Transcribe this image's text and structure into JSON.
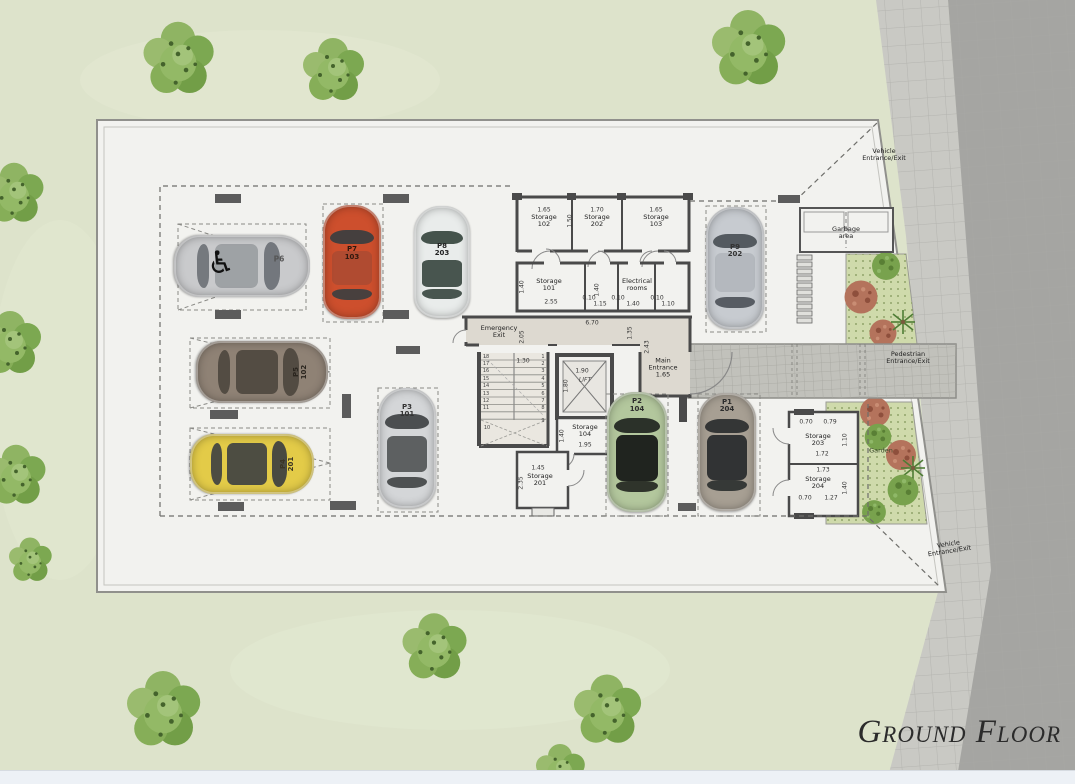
{
  "title": "Ground Floor",
  "entrances": {
    "vehicle_top": {
      "l1": "Vehicle",
      "l2": "Entrance/Exit"
    },
    "vehicle_bottom": {
      "l1": "Vehicle",
      "l2": "Entrance/Exit"
    },
    "pedestrian": {
      "l1": "Pedestrian",
      "l2": "Entrance/Exit"
    },
    "main": {
      "l1": "Main",
      "l2": "Entrance",
      "dim": "1.65"
    },
    "emergency": {
      "l1": "Emergency",
      "l2": "Exit"
    }
  },
  "areas": {
    "garbage": {
      "l1": "Garbage",
      "l2": "area"
    },
    "garden": "Garden",
    "lift": "LIFT",
    "electrical": {
      "l1": "Electrical",
      "l2": "rooms"
    }
  },
  "rooms": {
    "s102": {
      "name": "Storage",
      "number": "102"
    },
    "s202": {
      "name": "Storage",
      "number": "202"
    },
    "s103": {
      "name": "Storage",
      "number": "103"
    },
    "s101": {
      "name": "Storage",
      "number": "101"
    },
    "s104": {
      "name": "Storage",
      "number": "104"
    },
    "s201": {
      "name": "Storage",
      "number": "201"
    },
    "s203": {
      "name": "Storage",
      "number": "203"
    },
    "s204": {
      "name": "Storage",
      "number": "204"
    }
  },
  "parking": {
    "handicap_symbol": "♿",
    "p6_label": "P6",
    "spots": [
      {
        "label": "P7",
        "unit": "103",
        "cx": 352,
        "cy": 262,
        "w": 58,
        "h": 114,
        "rot": 0,
        "body": "#cd4f2d",
        "glass": "#3a3e40",
        "ro": 0.2,
        "rft": 40,
        "rfh": 30,
        "lt": "36%",
        "lr": 0,
        "lc": "#30180e"
      },
      {
        "label": "P8",
        "unit": "203",
        "cx": 442,
        "cy": 262,
        "w": 56,
        "h": 112,
        "rot": 0,
        "body": "#e9eceb",
        "glass": "#36453e",
        "ro": 0.9,
        "rft": 48,
        "rfh": 24,
        "lt": "33%",
        "lr": 0,
        "lc": "#222222"
      },
      {
        "label": "P9",
        "unit": "202",
        "cx": 735,
        "cy": 268,
        "w": 58,
        "h": 122,
        "rot": 0,
        "body": "#c7cbd0",
        "glass": "#4a5056",
        "ro": 0.15,
        "rft": 38,
        "rfh": 32,
        "lt": "30%",
        "lr": 0,
        "lc": "#333333"
      },
      {
        "label": "P5",
        "unit": "102",
        "cx": 262,
        "cy": 372,
        "w": 62,
        "h": 132,
        "rot": 90,
        "body": "#8f8275",
        "glass": "#4d463e",
        "ro": 0.9,
        "rft": 38,
        "rfh": 32,
        "lt": "15%",
        "lr": 180,
        "lc": "#2b261f"
      },
      {
        "label": "P4",
        "unit": "201",
        "cx": 252,
        "cy": 464,
        "w": 60,
        "h": 124,
        "rot": 90,
        "body": "#e3cb48",
        "glass": "#3c3f41",
        "ro": 0.9,
        "rft": 38,
        "rfh": 32,
        "lt": "15%",
        "lr": 180,
        "lc": "#3a3424"
      },
      {
        "label": "P3",
        "unit": "101",
        "cx": 407,
        "cy": 448,
        "w": 58,
        "h": 120,
        "rot": 0,
        "body": "#d4d6d8",
        "glass": "#3f4244",
        "ro": 0.8,
        "rft": 40,
        "rfh": 30,
        "lt": "13%",
        "lr": 0,
        "lc": "#333333"
      },
      {
        "label": "P2",
        "unit": "104",
        "cx": 637,
        "cy": 452,
        "w": 60,
        "h": 120,
        "rot": 0,
        "body": "#b3c79d",
        "glass": "#20241f",
        "ro": 1,
        "rft": 36,
        "rfh": 38,
        "lt": "5%",
        "lr": 0,
        "lc": "#2c2c2c"
      },
      {
        "label": "P1",
        "unit": "204",
        "cx": 727,
        "cy": 452,
        "w": 58,
        "h": 118,
        "rot": 0,
        "body": "#a79f93",
        "glass": "#2a2d2e",
        "ro": 0.95,
        "rft": 36,
        "rfh": 38,
        "lt": "5%",
        "lr": 0,
        "lc": "#2c2c2c"
      },
      {
        "label": "",
        "unit": "",
        "cx": 242,
        "cy": 266,
        "w": 62,
        "h": 136,
        "rot": 90,
        "body": "#c9cacc",
        "glass": "#6b7076",
        "ro": 0.45,
        "rft": 38,
        "rfh": 32,
        "lt": "50%",
        "lr": 0,
        "lc": "#333333"
      }
    ]
  },
  "stairs": {
    "left_flight": [
      "18",
      "17",
      "16",
      "15",
      "14",
      "13",
      "12",
      "11"
    ],
    "left_landing": "10",
    "right_flight": [
      "1",
      "2",
      "3",
      "4",
      "5",
      "6",
      "7",
      "8"
    ],
    "right_landing": "9"
  },
  "dimensions": [
    {
      "t": "1.65",
      "x": 544,
      "y": 210
    },
    {
      "t": "1.70",
      "x": 597,
      "y": 210
    },
    {
      "t": "1.65",
      "x": 656,
      "y": 210
    },
    {
      "t": "1.50",
      "x": 570,
      "y": 221,
      "r": -90
    },
    {
      "t": "1.40",
      "x": 522,
      "y": 287,
      "r": -90
    },
    {
      "t": "2.55",
      "x": 551,
      "y": 302
    },
    {
      "t": "0.10",
      "x": 589,
      "y": 298
    },
    {
      "t": "1.15",
      "x": 600,
      "y": 304
    },
    {
      "t": "0.10",
      "x": 618,
      "y": 298
    },
    {
      "t": "1.40",
      "x": 633,
      "y": 304
    },
    {
      "t": "0.10",
      "x": 657,
      "y": 298
    },
    {
      "t": "1.10",
      "x": 668,
      "y": 304
    },
    {
      "t": "1.40",
      "x": 597,
      "y": 290,
      "r": -90
    },
    {
      "t": "6.70",
      "x": 592,
      "y": 323
    },
    {
      "t": "2.05",
      "x": 522,
      "y": 337,
      "r": -90
    },
    {
      "t": "1.35",
      "x": 630,
      "y": 333,
      "r": -90
    },
    {
      "t": "2.43",
      "x": 647,
      "y": 347,
      "r": -90
    },
    {
      "t": "1.30",
      "x": 523,
      "y": 361
    },
    {
      "t": "1.90",
      "x": 582,
      "y": 371
    },
    {
      "t": "1.80",
      "x": 566,
      "y": 386,
      "r": -90
    },
    {
      "t": "1.40",
      "x": 562,
      "y": 436,
      "r": -90
    },
    {
      "t": "1.95",
      "x": 585,
      "y": 445
    },
    {
      "t": "1.45",
      "x": 538,
      "y": 468
    },
    {
      "t": "2.35",
      "x": 521,
      "y": 483,
      "r": -90
    },
    {
      "t": "0.70",
      "x": 806,
      "y": 422
    },
    {
      "t": "0.79",
      "x": 830,
      "y": 422
    },
    {
      "t": "1.72",
      "x": 822,
      "y": 454
    },
    {
      "t": "1.10",
      "x": 845,
      "y": 440,
      "r": -90
    },
    {
      "t": "1.73",
      "x": 823,
      "y": 470
    },
    {
      "t": "1.40",
      "x": 845,
      "y": 488,
      "r": -90
    },
    {
      "t": "0.70",
      "x": 805,
      "y": 498
    },
    {
      "t": "1.27",
      "x": 831,
      "y": 498
    }
  ]
}
